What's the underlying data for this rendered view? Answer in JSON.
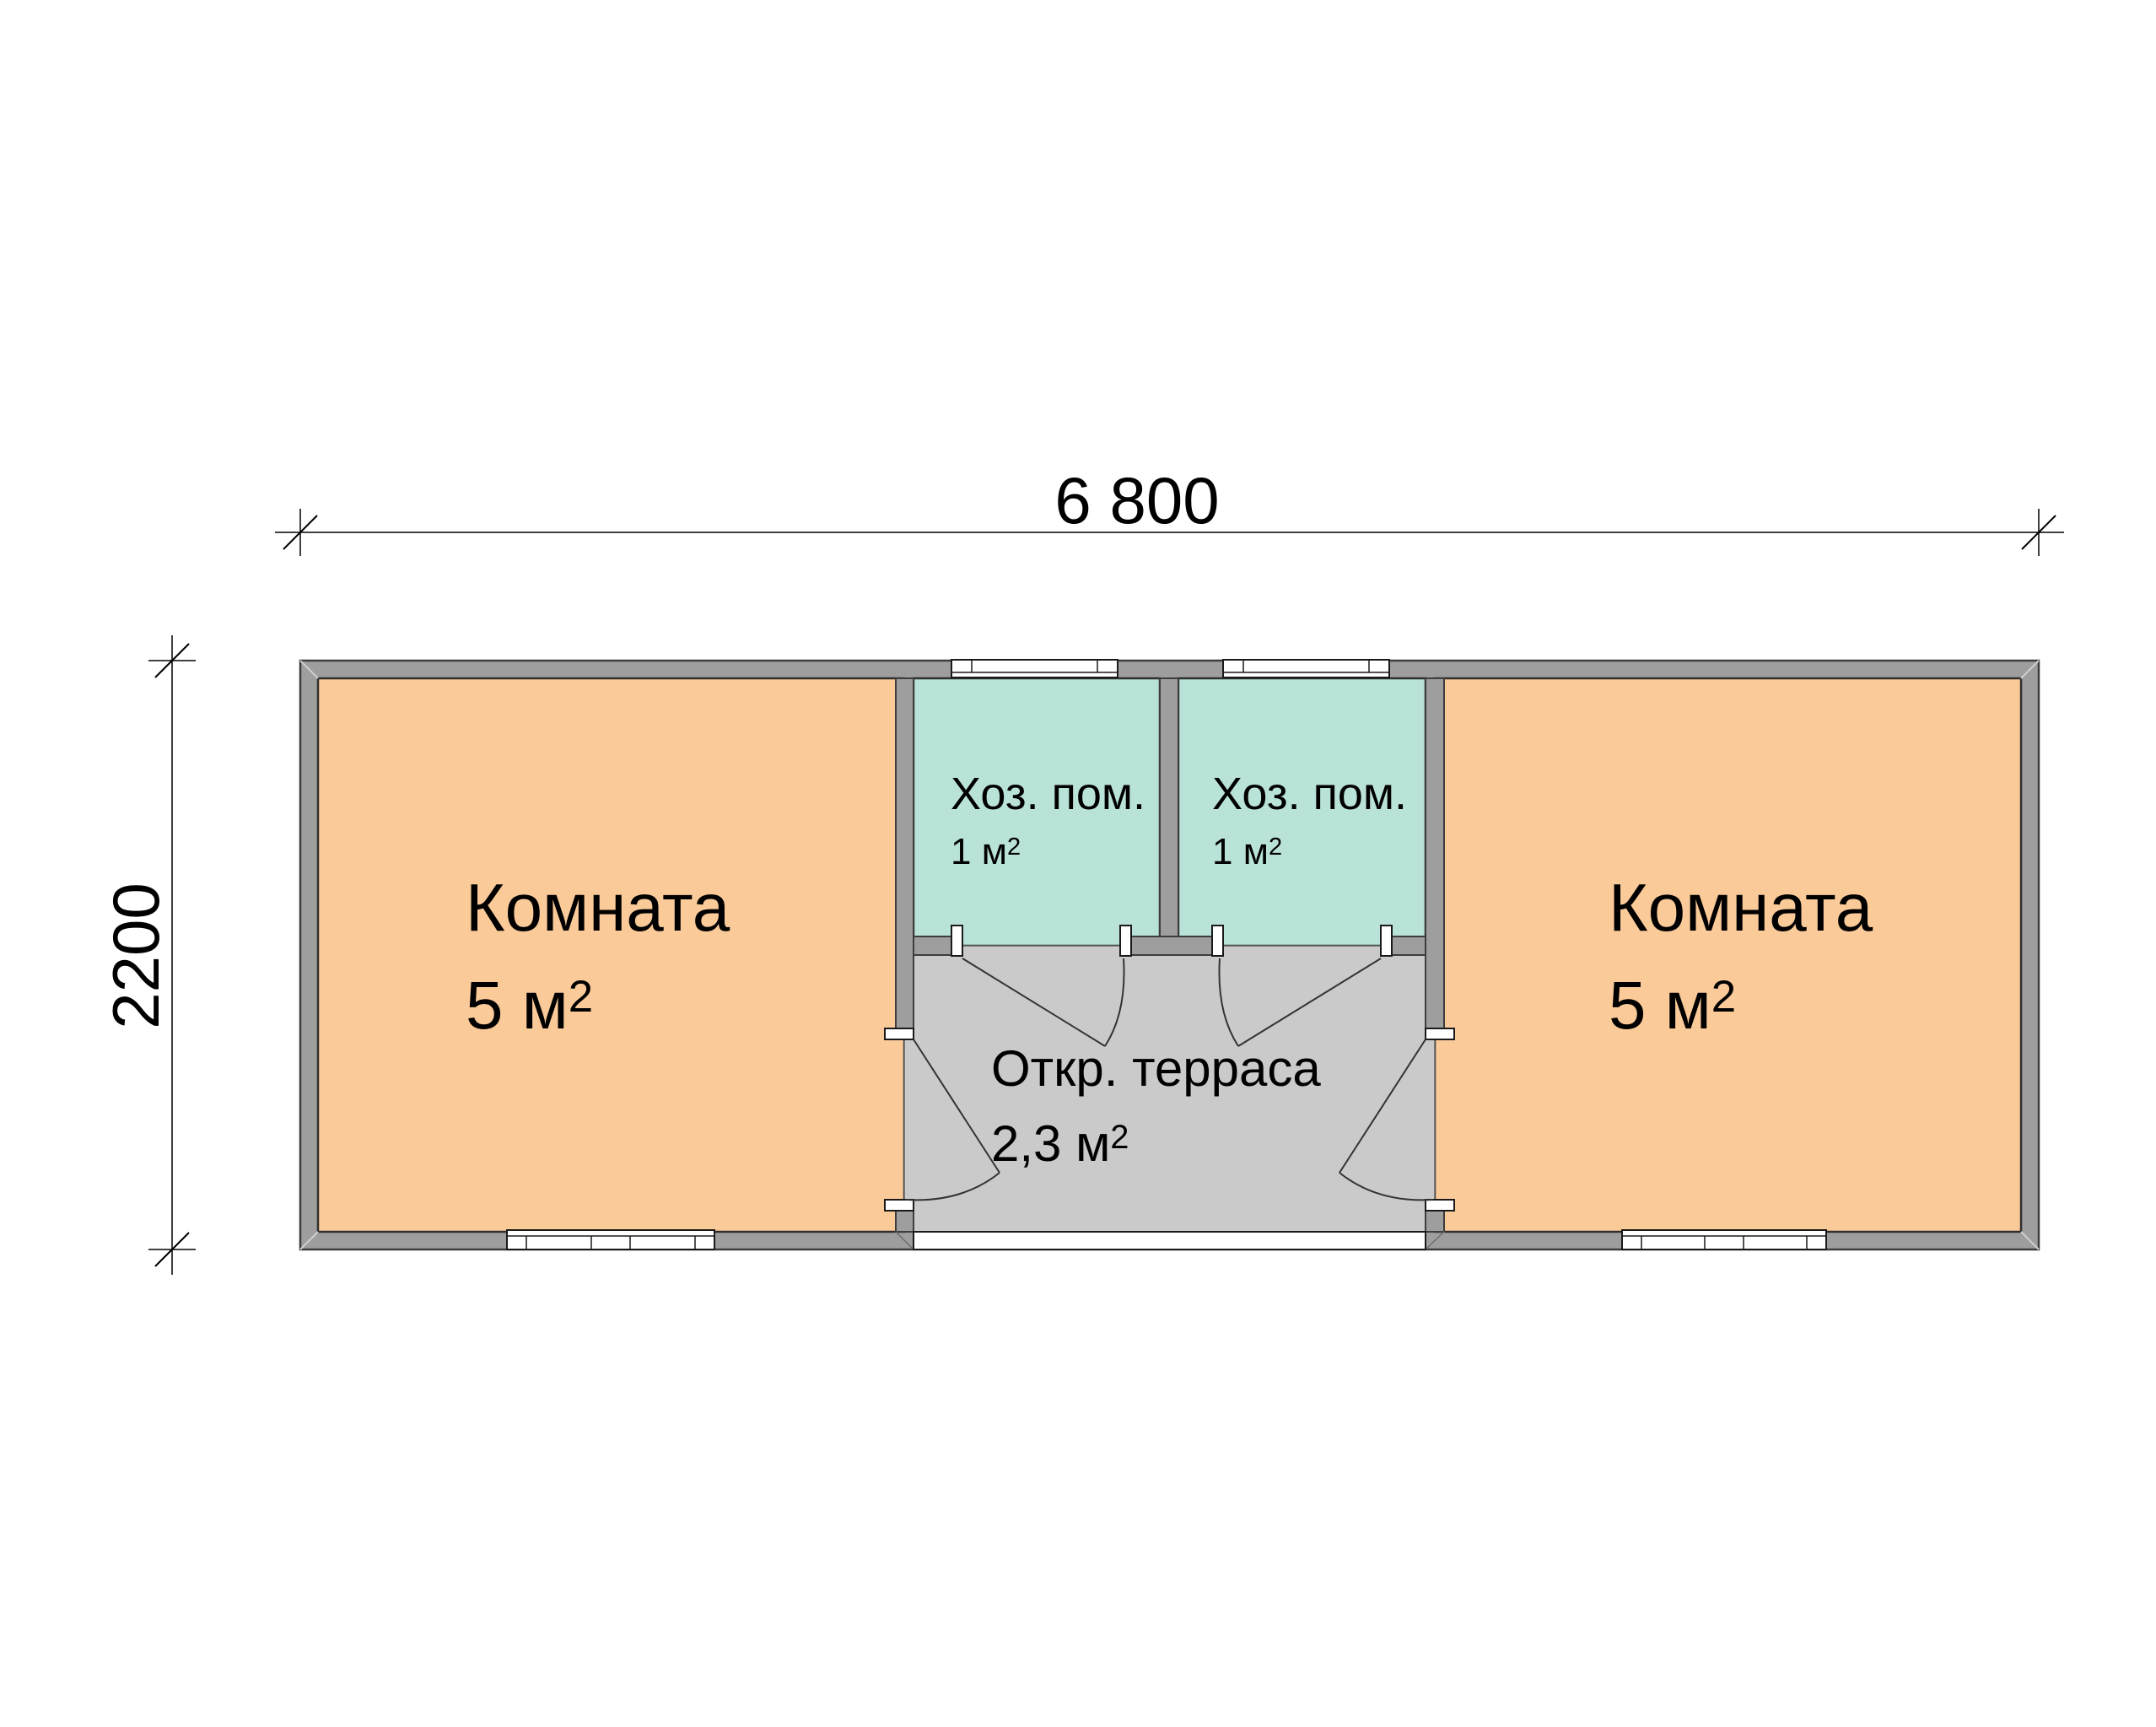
{
  "plan_title": "floor-plan",
  "dimensions": {
    "width_label": "6 800",
    "height_label": "2200"
  },
  "rooms": {
    "left": {
      "name": "Комната",
      "area_base": "5 м",
      "area_sup": "2"
    },
    "right": {
      "name": "Комната",
      "area_base": "5 м",
      "area_sup": "2"
    },
    "utility1": {
      "name": "Хоз. пом.",
      "area_base": "1 м",
      "area_sup": "2"
    },
    "utility2": {
      "name": "Хоз. пом.",
      "area_base": "1 м",
      "area_sup": "2"
    },
    "terrace": {
      "name": "Откр. терраса",
      "area_base": "2,3 м",
      "area_sup": "2"
    }
  },
  "colors": {
    "room_fill": "#FBCA99",
    "utility_fill": "#B9E2D8",
    "terrace_fill": "#CACACA",
    "wall_fill": "#9E9E9E",
    "wall_outline": "#3D3D3D",
    "line": "#333333",
    "background": "#FFFFFF"
  }
}
